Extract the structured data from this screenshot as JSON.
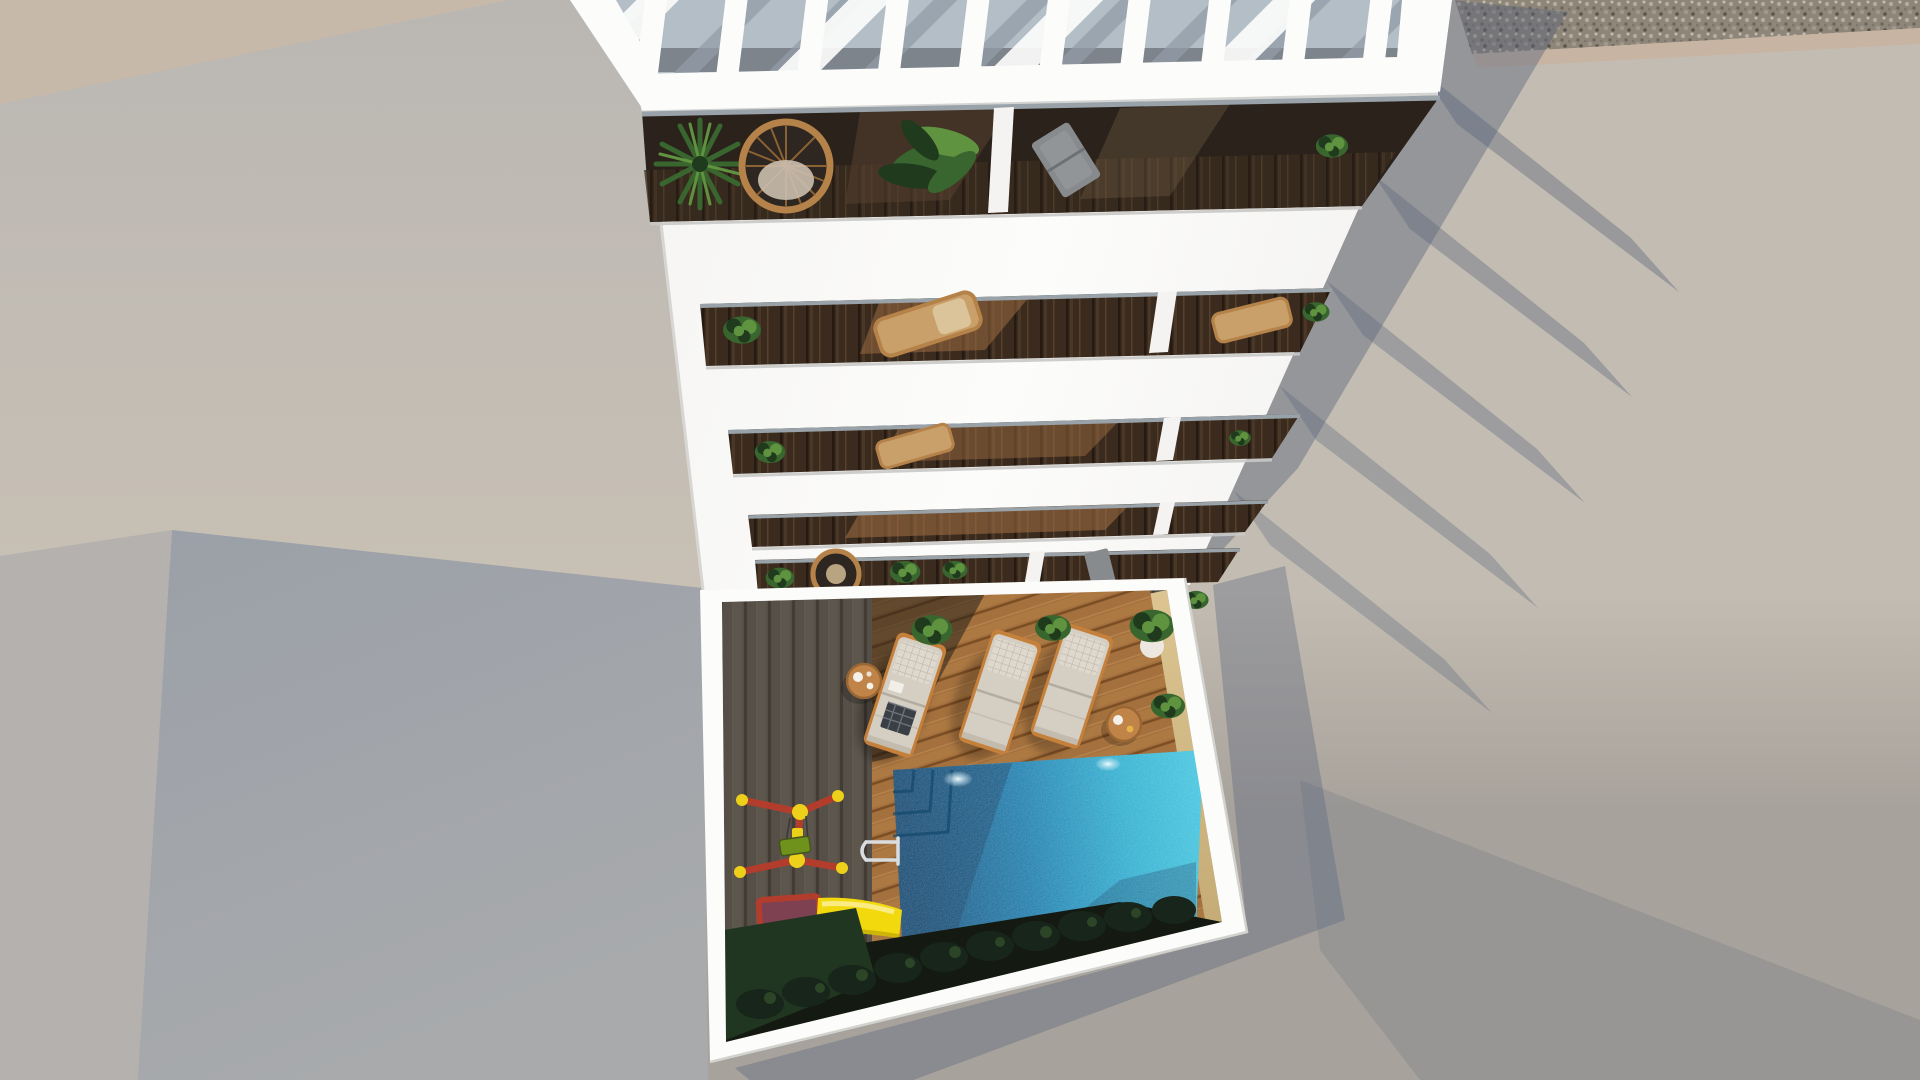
{
  "scene": {
    "type": "3d-architectural-render",
    "view": "top-down-aerial",
    "time_of_day": "daylight",
    "description": "Aerial top-down render of a white multi-storey apartment building with a slatted rooftop pergola, five planted balcony levels with rattan furniture, and a walled courtyard containing a turquoise swimming pool, three sun loungers, side tables, potted plants, a hedge row and a children's playground with a yellow slide."
  },
  "objects": {
    "pergola": {
      "label": "rooftop pergola",
      "slat_material": "white wood"
    },
    "balconies": {
      "count": 5,
      "floor_material": "dark wood deck",
      "furniture": [
        "rattan hanging chair",
        "rattan loungers",
        "folding chair",
        "round table"
      ],
      "plants": [
        "palm",
        "banana plant",
        "leafy shrubs"
      ]
    },
    "courtyard": {
      "pool": {
        "shape": "rectangular",
        "lights": 2,
        "ladder": true,
        "steps": true
      },
      "sun_loungers": {
        "count": 3,
        "orientation_deg": 18
      },
      "side_tables": {
        "count": 2
      },
      "playground": {
        "slide_color": "yellow",
        "frame_colors": [
          "red",
          "yellow"
        ],
        "platform_color": "maroon",
        "swing_color": "green"
      },
      "potted_plants": 5,
      "hedge_row": true,
      "deck": [
        "weathered grey planks (shadow)",
        "warm brown planks (sunlit)"
      ],
      "pool_surround": "sand-coloured stone"
    },
    "surroundings": [
      "concrete roof planes",
      "gravel strip",
      "cast building shadows"
    ]
  },
  "palette": {
    "groundRight": "#a7a29b",
    "roofRightTop": "#c3bcb2",
    "gravelBase": "#8e8679",
    "gravelEdge": "#c8b4a2",
    "roofTan": "#c6b9a9",
    "a2Top": "#bab7b3",
    "a2Bottom": "#c8c0b4",
    "l1Gray": "#b4b1ae",
    "l2Top": "#9ba0a8",
    "l2Bottom": "#a8aaac",
    "white": "#f4f3f1",
    "whiteBright": "#fcfcfb",
    "pergFloor": "#b4bec6",
    "pergShadow": "#939ca6",
    "terrDark": "#2a221b",
    "terrMid": "#53402e",
    "balWood": "#3a2b1e",
    "glass": "#98a2a8",
    "sunPatch": "#9c6b42",
    "deckGray": "#564f47",
    "deckGrayLine": "#423c35",
    "deckWarm": "#a4713e",
    "deckWarmLine": "#7c4e24",
    "sand": "#dcc592",
    "sandDeep": "#c3a973",
    "poolDeep": "#0e4a77",
    "poolMid": "#1579ab",
    "poolBright": "#27abce",
    "poolBright2": "#3cc4de",
    "poolShadow": "#0b3a61",
    "slideYellow": "#f2d90e",
    "slideDark": "#cdb409",
    "playRed": "#b23d2c",
    "playYellow": "#edd019",
    "playMaroon": "#7e4152",
    "playGreen": "#6f921c",
    "loungerFabric": "#d5cec3",
    "loungerPillow": "#ded8cd",
    "loungerFrame": "#c5803b",
    "tableWood": "#c08348",
    "plantDark": "#1f3a1c",
    "plantMid": "#39662e",
    "plantLight": "#5f9340",
    "shrub": "#17251a",
    "shrubLight": "#2c4526",
    "soil": "#141a12",
    "grass": "#213620",
    "rattan": "#b5824a",
    "chairGray": "#888b8e",
    "shadowBlue": "#55627a",
    "chrome": "#d9dde0"
  }
}
